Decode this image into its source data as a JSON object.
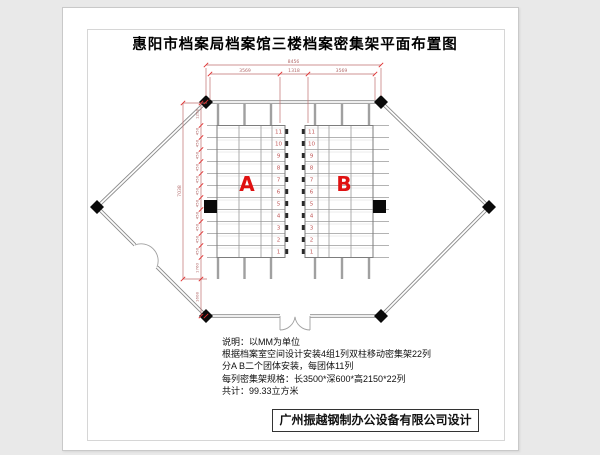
{
  "title": "惠阳市档案局档案馆三楼档案密集架平面布置图",
  "plan": {
    "block_labels": {
      "a": "A",
      "b": "B"
    },
    "row_numbers": [
      "11",
      "10",
      "9",
      "8",
      "7",
      "6",
      "5",
      "4",
      "3",
      "2",
      "1"
    ],
    "dimensions": {
      "top_total": "8456",
      "top_segments": [
        "3569",
        "1318",
        "3569"
      ],
      "left_total": "7038",
      "left_top": "1298",
      "left_row": "450",
      "left_bottom": "1760",
      "left_below": "1608"
    },
    "colors": {
      "dimension": "#b36b6b",
      "tick": "#e03030",
      "label_red": "#e01111",
      "row_number": "#c05858",
      "wall": "#8a8a8a",
      "column_black": "#0a0a0a"
    }
  },
  "notes": {
    "lines": [
      "说明：以MM为单位",
      "根据档案室空间设计安装4组1列双柱移动密集架22列",
      "分A B二个团体安装，每团体11列",
      "每列密集架规格：长3500*深600*高2150*22列",
      "共计：99.33立方米"
    ]
  },
  "footer": {
    "company": "广州振越钢制办公设备有限公司设计"
  }
}
